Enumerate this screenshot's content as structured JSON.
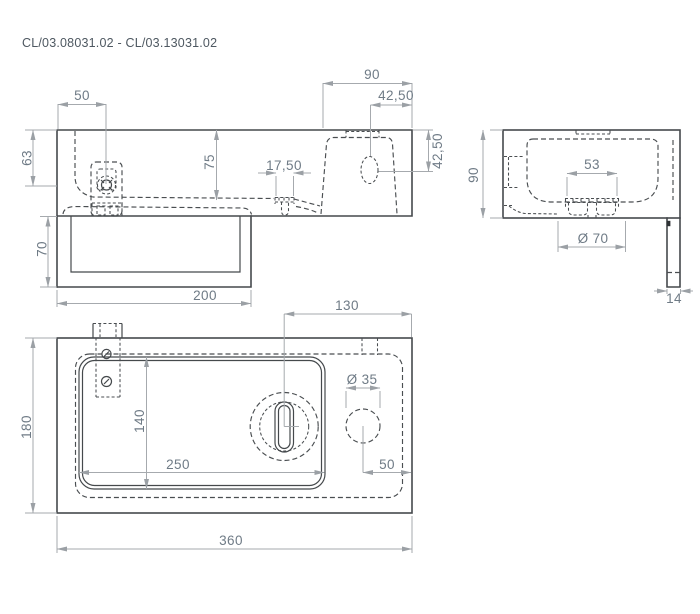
{
  "title": "CL/03.08031.02 - CL/03.13031.02",
  "front": {
    "d50": "50",
    "d63": "63",
    "d75": "75",
    "d90": "90",
    "d4250_top": "42,50",
    "d4250_side": "42,50",
    "d1750": "17,50",
    "d70": "70",
    "d200": "200"
  },
  "side": {
    "d90": "90",
    "d53": "53",
    "dia70": "Ø 70",
    "d14": "14"
  },
  "top": {
    "d130": "130",
    "d180": "180",
    "d140": "140",
    "d250": "250",
    "dia35": "Ø 35",
    "d50": "50",
    "d360": "360"
  },
  "colors": {
    "outline": "#45494c",
    "hidden": "#4a4e51",
    "dimension_line": "#a6aaae",
    "dimension_text": "#6f7b86",
    "title_text": "#4e5861",
    "background": "#ffffff"
  }
}
